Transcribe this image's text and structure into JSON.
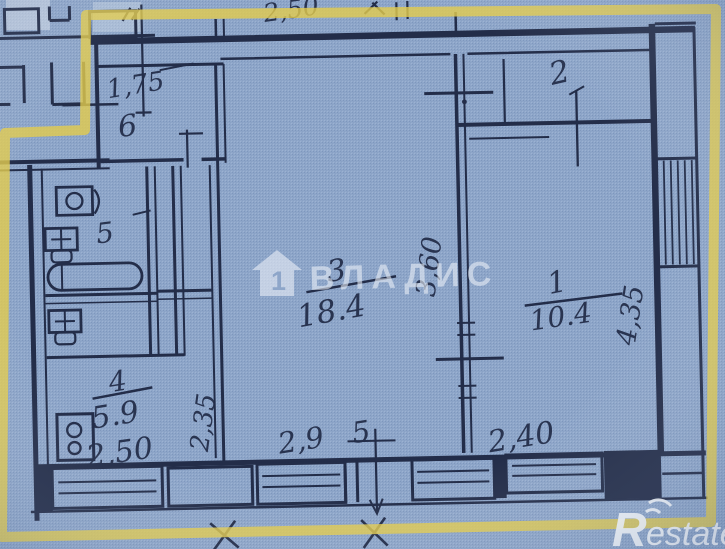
{
  "document": {
    "kind": "apartment floor plan scan"
  },
  "plan": {
    "dim_top": "2,50",
    "rooms": {
      "hall": {
        "number": "6",
        "dim": "1,75"
      },
      "bath": {
        "number": "5"
      },
      "kitchen": {
        "number": "4",
        "area": "5.9",
        "dim_width": "2,50",
        "dim_depth": "2,35"
      },
      "living": {
        "number": "3",
        "area": "18.4",
        "dim_width_left": "2,9",
        "dim_width_right": "5",
        "dim_depth": "3,60"
      },
      "bedroom2": {
        "number": "2"
      },
      "bedroom1": {
        "number": "1",
        "area": "10.4",
        "dim_width": "2,40",
        "dim_depth": "4,35"
      }
    }
  },
  "watermarks": {
    "agency_name": "ВЛАДИС",
    "agency_house_number": "1",
    "logo_initial": "R",
    "logo_suffix": "estate"
  },
  "colors": {
    "paper": "#8ea6c9",
    "ink": "#232d49",
    "highlight": "#e4cc4e",
    "watermark": "#e9eff7"
  }
}
